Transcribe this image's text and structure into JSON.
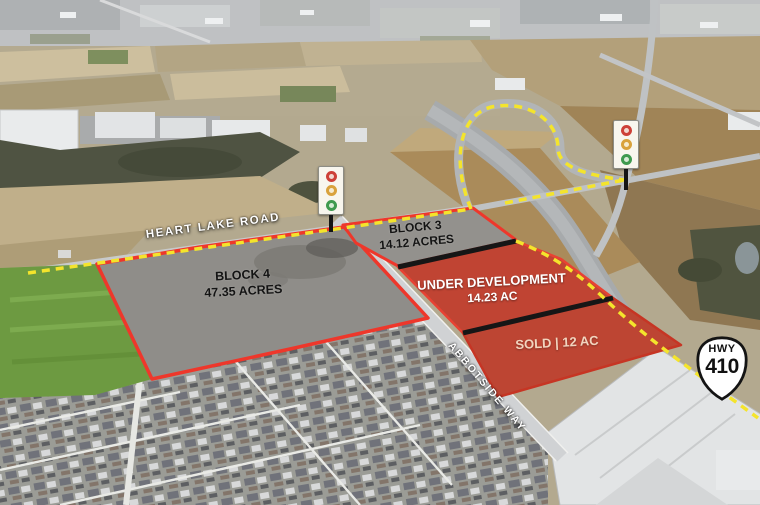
{
  "roads": {
    "heart_lake": "HEART LAKE ROAD",
    "abbotside": "ABBOTSIDE WAY"
  },
  "highway_shield": {
    "prefix": "HWY",
    "number": "410"
  },
  "parcels": [
    {
      "id": "block-4",
      "lines": [
        "BLOCK 4",
        "47.35 ACRES"
      ],
      "fill": "#8f8d89",
      "outline": "#ee372b",
      "label_color": "#141414"
    },
    {
      "id": "block-3",
      "lines": [
        "BLOCK 3",
        "14.12 ACRES"
      ],
      "fill": "#93918d",
      "outline": "#ee372b",
      "label_color": "#141414"
    },
    {
      "id": "under-development",
      "lines": [
        "UNDER DEVELOPMENT",
        "14.23 AC"
      ],
      "fill": "#c04433",
      "outline": "#e84233",
      "label_color": "#ffffff"
    },
    {
      "id": "sold",
      "lines": [
        "SOLD | 12 AC"
      ],
      "fill": "#bd4533",
      "outline": "#801f15",
      "label_color": "#f2d5bf"
    }
  ],
  "colors": {
    "route_dash": "#f4e42c",
    "parcel_divider": "#161616",
    "parcel_outline": "#ee372b"
  },
  "markers": {
    "traffic_signal_count": 2,
    "signal_lights": [
      "red",
      "amber",
      "green"
    ]
  }
}
